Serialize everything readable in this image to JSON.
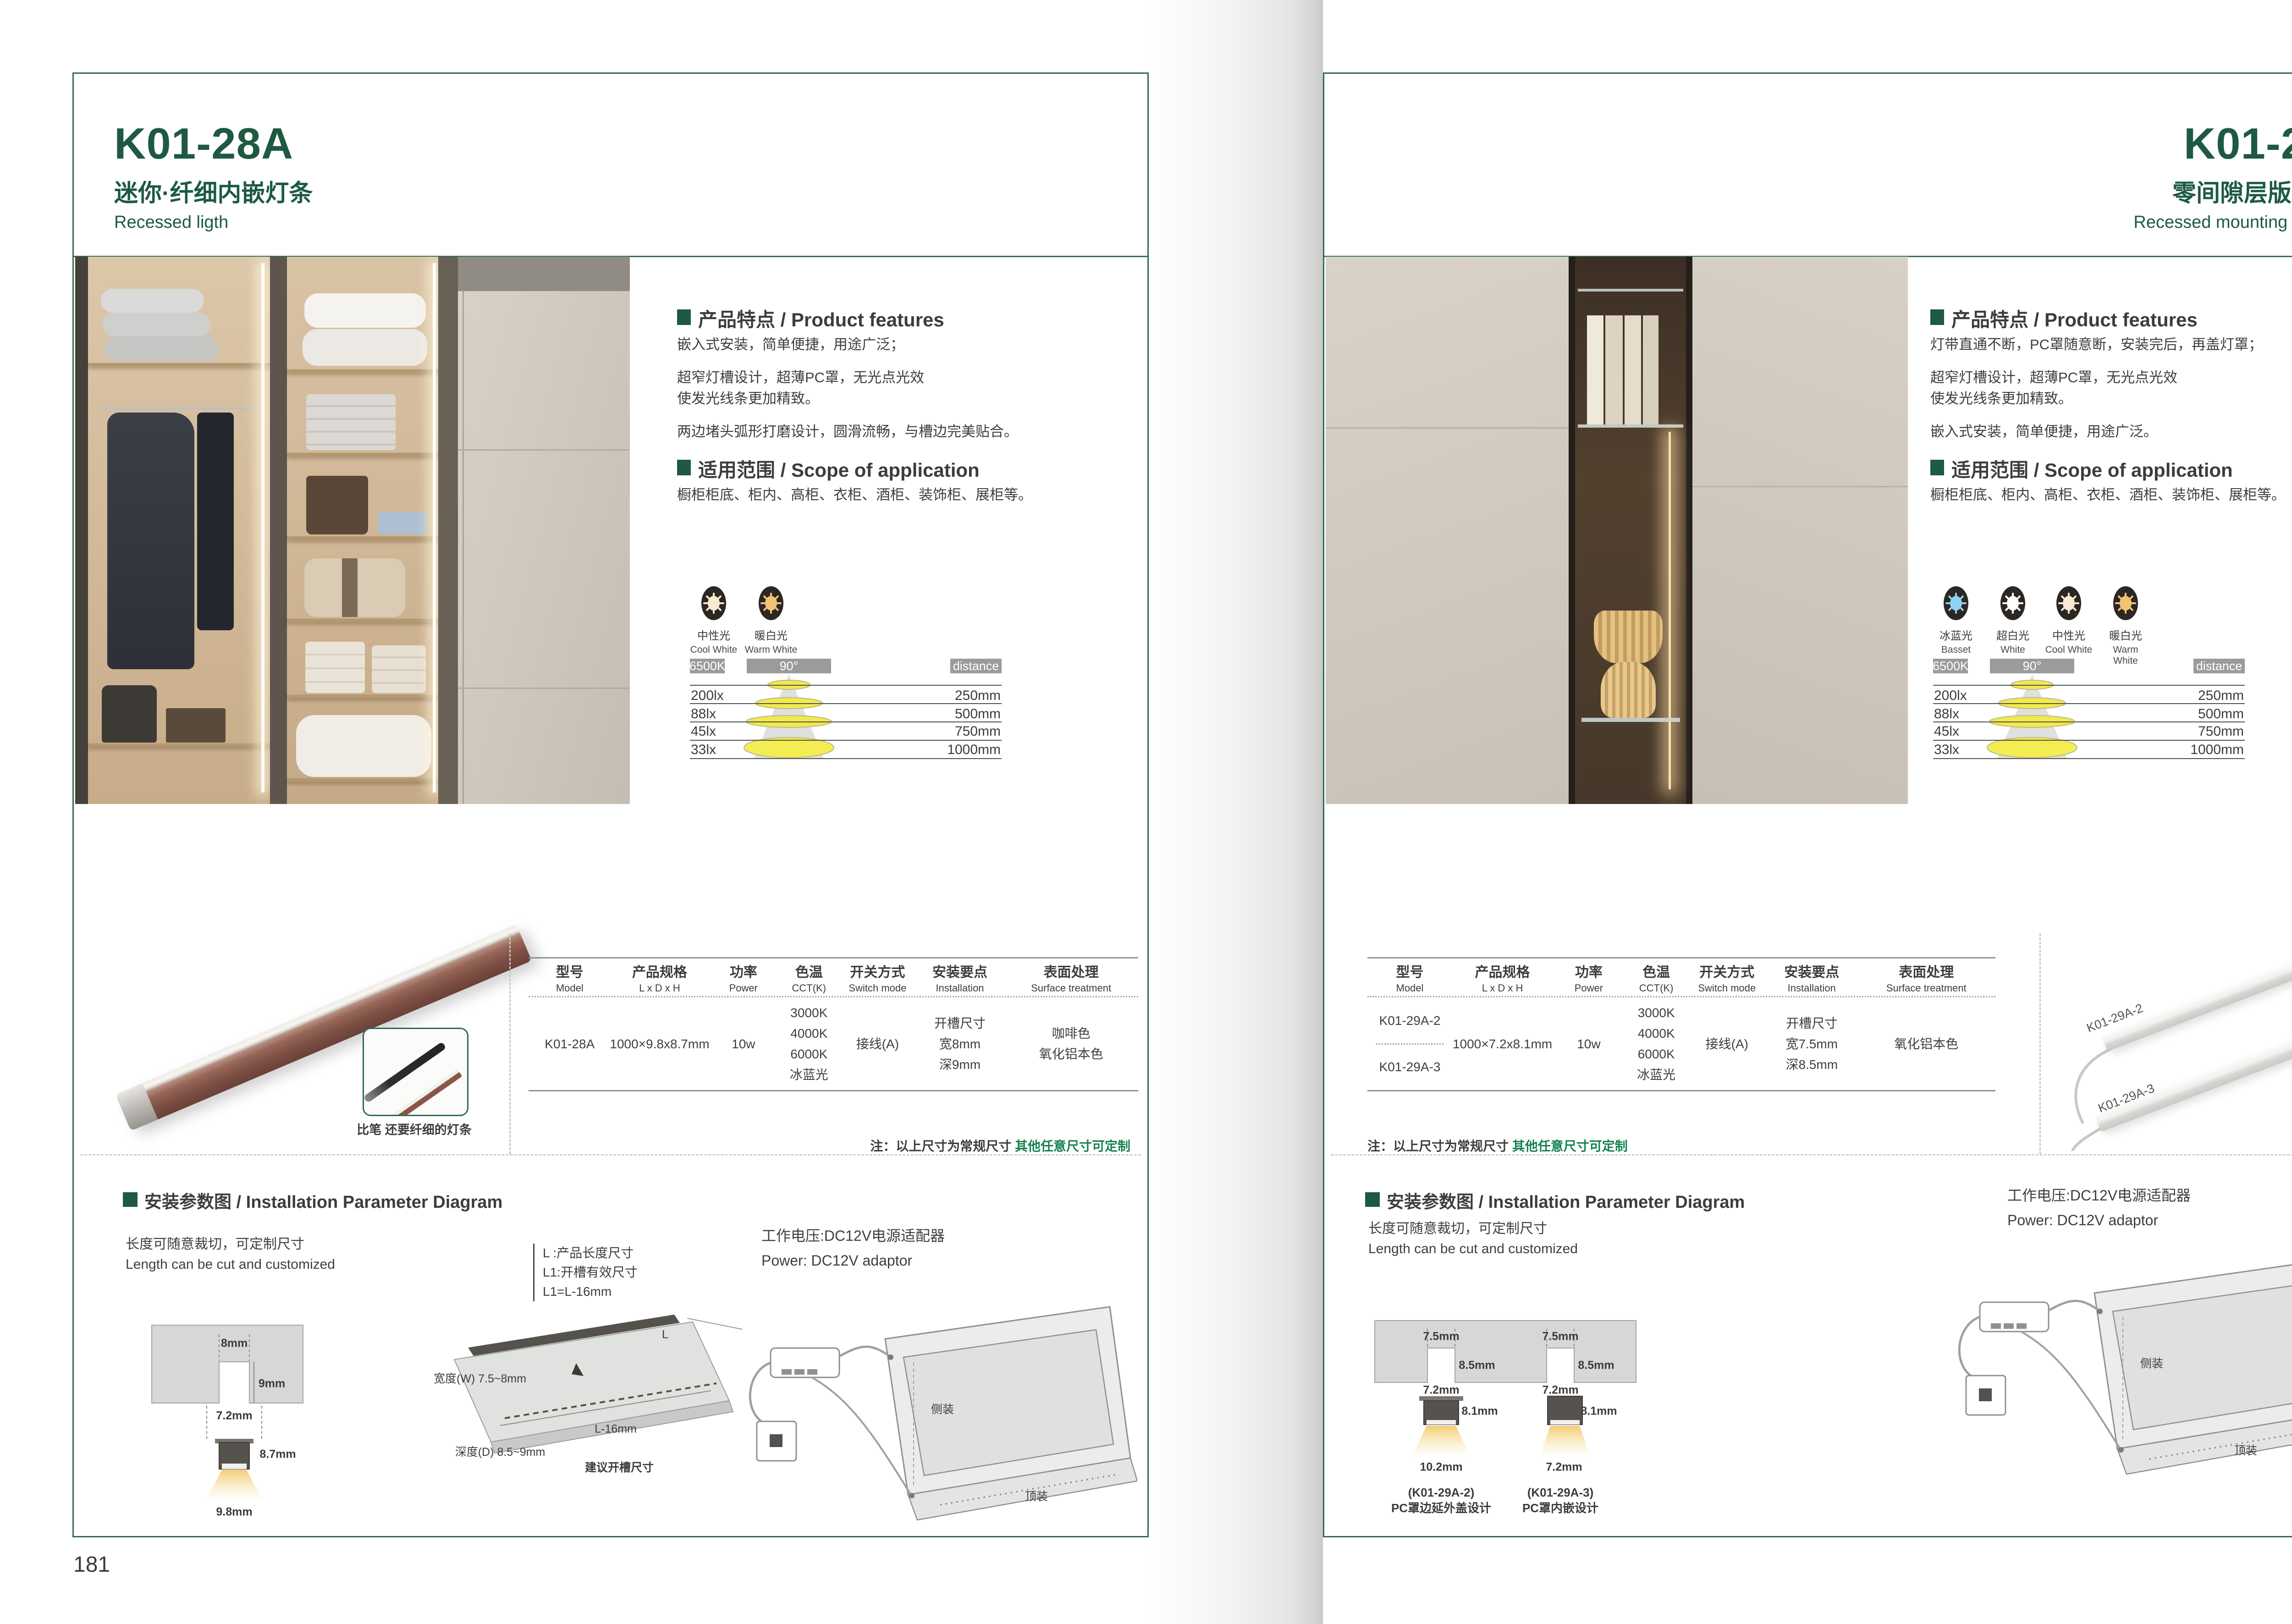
{
  "shared": {
    "brand_accent": "#1d5a41",
    "note_green_color": "#14814e",
    "features_heading": "产品特点 / Product features",
    "scope_heading": "适用范围 / Scope of application",
    "scope_text": "橱柜柜底、柜内、高柜、衣柜、酒柜、装饰柜、展柜等。",
    "photometry": {
      "cct": "6500K",
      "beam": "90°",
      "distance": "distance",
      "rows": [
        {
          "lx": "200lx",
          "mm": "250mm"
        },
        {
          "lx": "88lx",
          "mm": "500mm"
        },
        {
          "lx": "45lx",
          "mm": "750mm"
        },
        {
          "lx": "33lx",
          "mm": "1000mm"
        }
      ]
    },
    "table_headers": {
      "model_cn": "型号",
      "model_en": "Model",
      "size_cn": "产品规格",
      "size_en": "L x D x H",
      "power_cn": "功率",
      "power_en": "Power",
      "cct_cn": "色温",
      "cct_en": "CCT(K)",
      "switch_cn": "开关方式",
      "switch_en": "Switch mode",
      "install_cn": "安装要点",
      "install_en": "Installation",
      "surface_cn": "表面处理",
      "surface_en": "Surface treatment"
    },
    "note": {
      "label": "注：以上尺寸为常规尺寸 ",
      "highlight": "其他任意尺寸可定制"
    },
    "install": {
      "heading": "安装参数图 / Installation Parameter Diagram",
      "cut_cn": "长度可随意裁切，可定制尺寸",
      "cut_en": "Length can be cut and customized",
      "power_cn": "工作电压:DC12V电源适配器",
      "power_en": "Power: DC12V adaptor",
      "cab_side": "侧装",
      "cab_top": "顶装"
    }
  },
  "left": {
    "page_no": "181",
    "model": "K01-28A",
    "subtitle_cn": "迷你·纤细内嵌灯条",
    "subtitle_en": "Recessed ligth",
    "features": [
      "嵌入式安装，简单便捷，用途广泛；",
      "超窄灯槽设计，超薄PC罩，无光点光效",
      "使发光线条更加精致。",
      "两边堵头弧形打磨设计，圆滑流畅，与槽边完美贴合。"
    ],
    "icons": [
      {
        "cn": "中性光",
        "en": "Cool White",
        "hex": "#f6ead0"
      },
      {
        "cn": "暖白光",
        "en": "Warm White",
        "hex": "#f0c377"
      }
    ],
    "table": {
      "model": "K01-28A",
      "size": "1000×9.8x8.7mm",
      "power": "10w",
      "cct": [
        "3000K",
        "4000K",
        "6000K",
        "冰蓝光"
      ],
      "switch": "接线(A)",
      "install": [
        "开槽尺寸",
        "宽8mm",
        "深9mm"
      ],
      "surface": [
        "咖啡色",
        "氧化铝本色"
      ]
    },
    "product_caption": "比笔 还要纤细的灯条",
    "install": {
      "dim_top": "8mm",
      "dim_depth": "9mm",
      "dim_w": "7.2mm",
      "dim_h": "8.7mm",
      "dim_bottom": "9.8mm",
      "legend": [
        "L  :产品长度尺寸",
        "L1:开槽有效尺寸",
        "L1=L-16mm"
      ],
      "board_l": "L",
      "board_w": "宽度(W) 7.5~8mm",
      "board_l16": "L-16mm",
      "board_d": "深度(D) 8.5~9mm",
      "board_caption": "建议开槽尺寸"
    }
  },
  "right": {
    "page_no": "182",
    "model": "K01-29A",
    "subtitle_cn": "零间隙层版条形灯",
    "subtitle_en": "Recessed mounting LED light",
    "features": [
      "灯带直通不断，PC罩随意断，安装完后，再盖灯罩；",
      "超窄灯槽设计，超薄PC罩，无光点光效",
      "使发光线条更加精致。",
      "嵌入式安装，简单便捷，用途广泛。"
    ],
    "icons": [
      {
        "cn": "冰蓝光",
        "en": "Basset",
        "hex": "#8ed2f2"
      },
      {
        "cn": "超白光",
        "en": "White",
        "hex": "#ffffff"
      },
      {
        "cn": "中性光",
        "en": "Cool White",
        "hex": "#f6ead0"
      },
      {
        "cn": "暖白光",
        "en": "Warm White",
        "hex": "#f0c377"
      }
    ],
    "table": {
      "model_a": "K01-29A-2",
      "model_b": "K01-29A-3",
      "size": "1000×7.2x8.1mm",
      "power": "10w",
      "cct": [
        "3000K",
        "4000K",
        "6000K",
        "冰蓝光"
      ],
      "switch": "接线(A)",
      "install": [
        "开槽尺寸",
        "宽7.5mm",
        "深8.5mm"
      ],
      "surface": [
        "氧化铝本色"
      ]
    },
    "strip_labels": [
      "K01-29A-2",
      "K01-29A-3"
    ],
    "install": {
      "slot_w": "7.5mm",
      "slot_d": "8.5mm",
      "profile_w": "7.2mm",
      "profile_h": "8.1mm",
      "base_a": "10.2mm",
      "base_b": "7.2mm",
      "cap_a_model": "(K01-29A-2)",
      "cap_a_desc": "PC罩边延外盖设计",
      "cap_b_model": "(K01-29A-3)",
      "cap_b_desc": "PC罩内嵌设计"
    }
  }
}
